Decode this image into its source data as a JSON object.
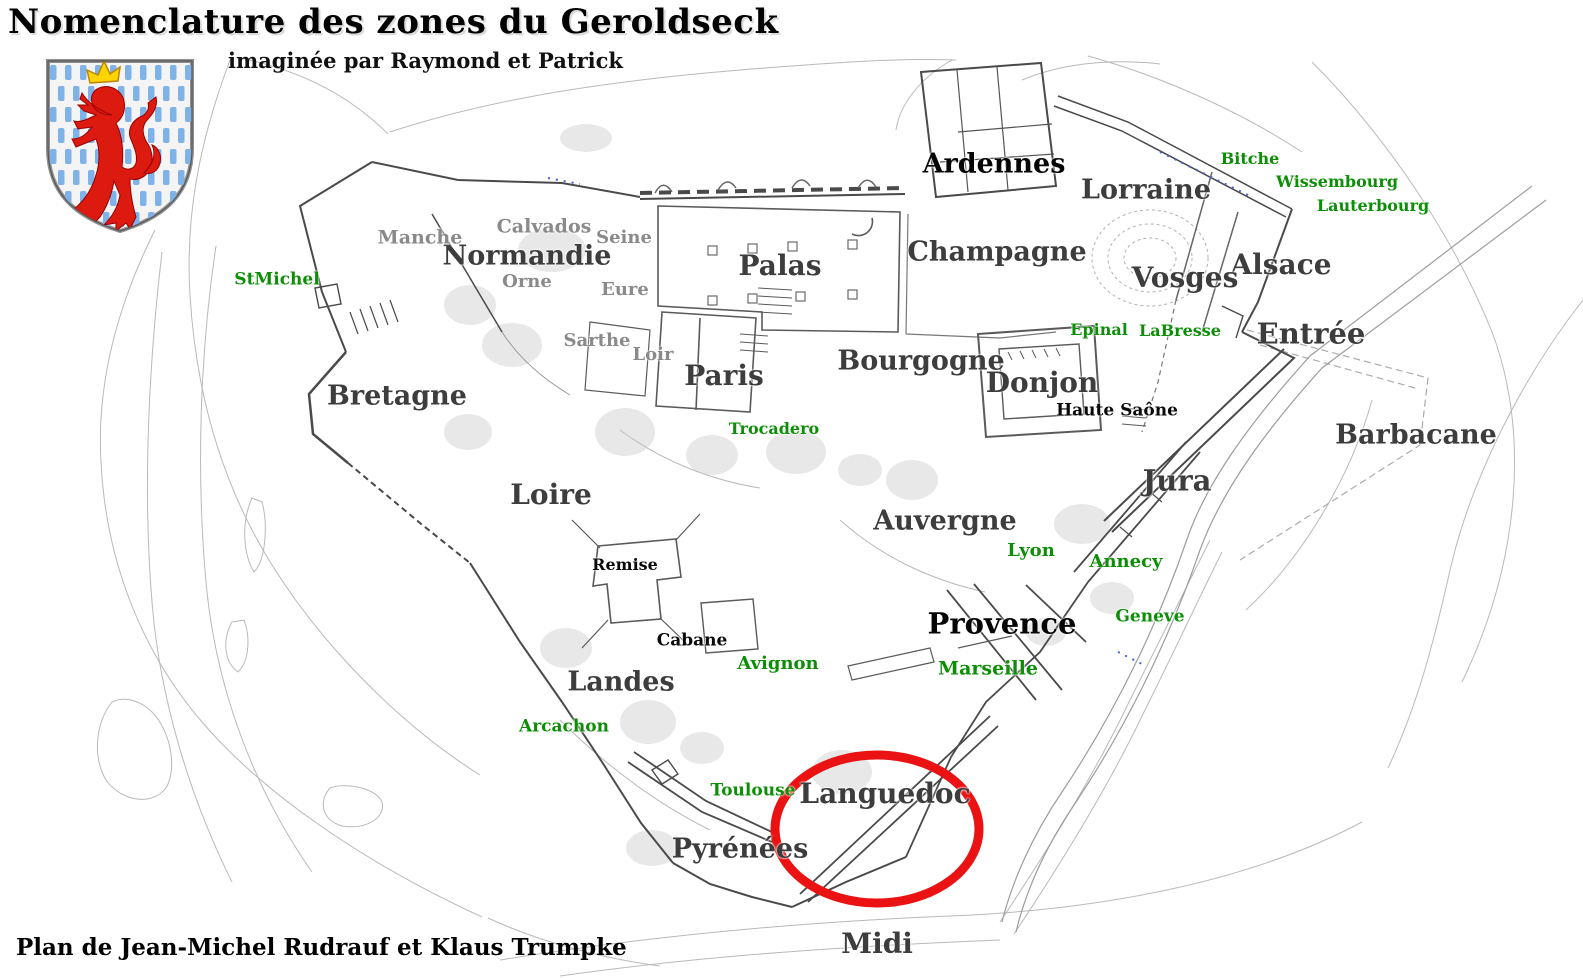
{
  "title": "Nomenclature des zones du Geroldseck",
  "subtitle": "imaginée par Raymond et Patrick",
  "footer": "Plan de Jean-Michel Rudrauf et Klaus Trumpke",
  "colors": {
    "region_label": "#3d3d3d",
    "black_label": "#050505",
    "minor_label": "#8a8a8a",
    "place_label": "#0c8f06",
    "highlight_ellipse": "#ea1212",
    "wall_line": "#4a4a4a",
    "contour_line": "#b9b9b9",
    "path_dots_blue": "#4a5fd0",
    "shield_stripe": "#7fb3e8",
    "lion_red": "#dd1a10",
    "crown_yellow": "#ffd400"
  },
  "coat_of_arms": {
    "name": "luxembourg-lion-shield"
  },
  "highlight": {
    "shape": "ellipse",
    "around": "Languedoc",
    "cx": 877,
    "cy": 829,
    "rx": 102,
    "ry": 74,
    "stroke_width": 9
  },
  "labels": [
    {
      "text": "Normandie",
      "x": 527,
      "y": 256,
      "size": 27,
      "kind": "region"
    },
    {
      "text": "Paris",
      "x": 724,
      "y": 376,
      "size": 28,
      "kind": "region"
    },
    {
      "text": "Palas",
      "x": 780,
      "y": 266,
      "size": 28,
      "kind": "region"
    },
    {
      "text": "Champagne",
      "x": 997,
      "y": 252,
      "size": 27,
      "kind": "region"
    },
    {
      "text": "Ardennes",
      "x": 994,
      "y": 164,
      "size": 27,
      "kind": "region-black"
    },
    {
      "text": "Lorraine",
      "x": 1146,
      "y": 190,
      "size": 27,
      "kind": "region"
    },
    {
      "text": "Alsace",
      "x": 1281,
      "y": 265,
      "size": 28,
      "kind": "region"
    },
    {
      "text": "Vosges",
      "x": 1185,
      "y": 278,
      "size": 28,
      "kind": "region"
    },
    {
      "text": "Entrée",
      "x": 1311,
      "y": 334,
      "size": 29,
      "kind": "region"
    },
    {
      "text": "Bourgogne",
      "x": 921,
      "y": 361,
      "size": 27,
      "kind": "region"
    },
    {
      "text": "Donjon",
      "x": 1042,
      "y": 383,
      "size": 28,
      "kind": "region"
    },
    {
      "text": "Bretagne",
      "x": 397,
      "y": 396,
      "size": 27,
      "kind": "region"
    },
    {
      "text": "Loire",
      "x": 551,
      "y": 495,
      "size": 28,
      "kind": "region"
    },
    {
      "text": "Auvergne",
      "x": 945,
      "y": 521,
      "size": 27,
      "kind": "region"
    },
    {
      "text": "Jura",
      "x": 1177,
      "y": 481,
      "size": 29,
      "kind": "region"
    },
    {
      "text": "Barbacane",
      "x": 1416,
      "y": 435,
      "size": 27,
      "kind": "region"
    },
    {
      "text": "Provence",
      "x": 1002,
      "y": 624,
      "size": 29,
      "kind": "region-black"
    },
    {
      "text": "Landes",
      "x": 621,
      "y": 682,
      "size": 27,
      "kind": "region"
    },
    {
      "text": "Languedoc",
      "x": 885,
      "y": 794,
      "size": 28,
      "kind": "region"
    },
    {
      "text": "Pyrénées",
      "x": 740,
      "y": 849,
      "size": 27,
      "kind": "region"
    },
    {
      "text": "Midi",
      "x": 877,
      "y": 944,
      "size": 28,
      "kind": "region"
    },
    {
      "text": "Haute Saône",
      "x": 1117,
      "y": 411,
      "size": 17,
      "kind": "building"
    },
    {
      "text": "Remise",
      "x": 625,
      "y": 565,
      "size": 16,
      "kind": "building"
    },
    {
      "text": "Cabane",
      "x": 692,
      "y": 641,
      "size": 17,
      "kind": "building"
    },
    {
      "text": "Manche",
      "x": 420,
      "y": 238,
      "size": 19,
      "kind": "minor"
    },
    {
      "text": "Calvados",
      "x": 544,
      "y": 227,
      "size": 19,
      "kind": "minor"
    },
    {
      "text": "Seine",
      "x": 624,
      "y": 238,
      "size": 18,
      "kind": "minor"
    },
    {
      "text": "Orne",
      "x": 527,
      "y": 282,
      "size": 18,
      "kind": "minor"
    },
    {
      "text": "Eure",
      "x": 625,
      "y": 290,
      "size": 18,
      "kind": "minor"
    },
    {
      "text": "Sarthe",
      "x": 597,
      "y": 341,
      "size": 18,
      "kind": "minor"
    },
    {
      "text": "Loir",
      "x": 653,
      "y": 355,
      "size": 18,
      "kind": "minor"
    },
    {
      "text": "StMichel",
      "x": 277,
      "y": 280,
      "size": 17,
      "kind": "place"
    },
    {
      "text": "Bitche",
      "x": 1250,
      "y": 159,
      "size": 16,
      "kind": "place"
    },
    {
      "text": "Wissembourg",
      "x": 1337,
      "y": 182,
      "size": 16,
      "kind": "place"
    },
    {
      "text": "Lauterbourg",
      "x": 1373,
      "y": 206,
      "size": 16,
      "kind": "place"
    },
    {
      "text": "Epinal",
      "x": 1099,
      "y": 330,
      "size": 16,
      "kind": "place"
    },
    {
      "text": "LaBresse",
      "x": 1180,
      "y": 331,
      "size": 16,
      "kind": "place"
    },
    {
      "text": "Trocadero",
      "x": 774,
      "y": 429,
      "size": 16,
      "kind": "place"
    },
    {
      "text": "Lyon",
      "x": 1031,
      "y": 551,
      "size": 18,
      "kind": "place"
    },
    {
      "text": "Annecy",
      "x": 1126,
      "y": 562,
      "size": 18,
      "kind": "place"
    },
    {
      "text": "Geneve",
      "x": 1150,
      "y": 617,
      "size": 17,
      "kind": "place"
    },
    {
      "text": "Marseille",
      "x": 988,
      "y": 669,
      "size": 19,
      "kind": "place"
    },
    {
      "text": "Avignon",
      "x": 778,
      "y": 664,
      "size": 18,
      "kind": "place"
    },
    {
      "text": "Arcachon",
      "x": 564,
      "y": 727,
      "size": 17,
      "kind": "place"
    },
    {
      "text": "Toulouse",
      "x": 753,
      "y": 791,
      "size": 17,
      "kind": "place"
    }
  ]
}
